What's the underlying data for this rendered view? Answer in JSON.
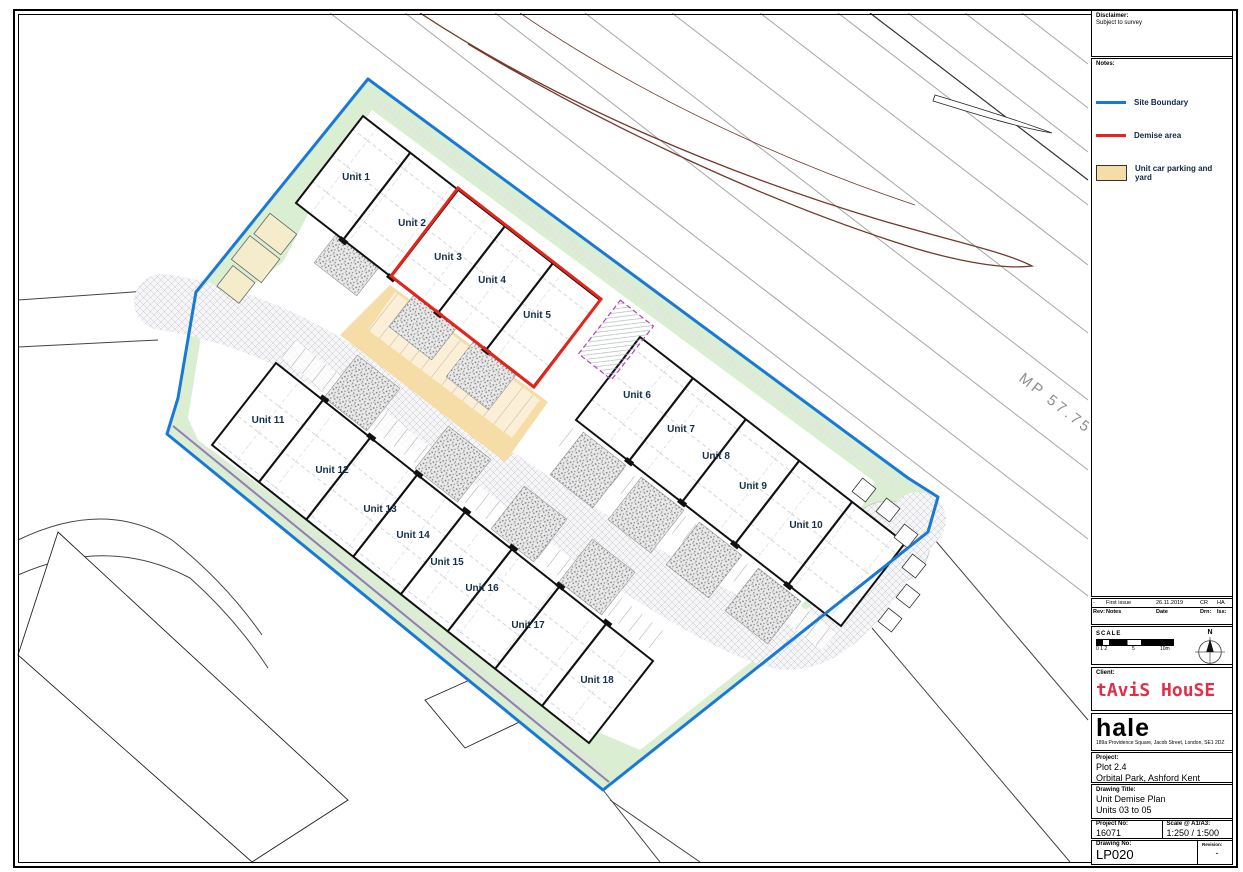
{
  "titleblock": {
    "disclaimer": {
      "label": "Disclaimer:",
      "body": "Subject to survey"
    },
    "notes_label": "Notes:",
    "legend": {
      "items": [
        {
          "swatch": "blue-line",
          "label": "Site Boundary"
        },
        {
          "swatch": "red-line",
          "label": "Demise area"
        },
        {
          "swatch": "tan-fill",
          "label": "Unit car parking and yard"
        }
      ]
    },
    "revisions": {
      "row": {
        "rev": "-",
        "notes": "First issue",
        "date": "26.11.2019",
        "drn": "CR",
        "iss": "HA"
      },
      "headers": {
        "rev": "Rev:",
        "notes": "Notes",
        "date": "Date",
        "drn": "Drn:",
        "iss": "Iss:"
      }
    },
    "scale_bar": {
      "label": "SCALE",
      "tick_left": "0 1 2",
      "tick_mid": "5",
      "tick_right": "10m"
    },
    "north": {
      "label": "N"
    },
    "client": {
      "label": "Client:",
      "name": "tAviS HouSE"
    },
    "firm": {
      "name": "hale",
      "address": "189a Providence Square, Jacob Street, London, SE1 2DZ"
    },
    "project": {
      "label": "Project:",
      "line1": "Plot 2.4",
      "line2": "Orbital Park, Ashford Kent"
    },
    "drawing_title": {
      "label": "Drawing Title:",
      "line1": "Unit Demise Plan",
      "line2": "Units 03 to 05"
    },
    "numbers": {
      "project_no_label": "Project No:",
      "project_no": "16071",
      "scale_label": "Scale @ A1/A3:",
      "scale": "1:250 / 1:500",
      "drawing_no_label": "Drawing No:",
      "drawing_no": "LP020",
      "revision_label": "Revision:",
      "revision": "-"
    }
  },
  "plan": {
    "milepost": "MP 57.75",
    "units": [
      {
        "label": "Unit 1",
        "x": 356,
        "y": 180
      },
      {
        "label": "Unit 2",
        "x": 412,
        "y": 226
      },
      {
        "label": "Unit 3",
        "x": 448,
        "y": 260
      },
      {
        "label": "Unit 4",
        "x": 492,
        "y": 283
      },
      {
        "label": "Unit 5",
        "x": 537,
        "y": 318
      },
      {
        "label": "Unit 6",
        "x": 637,
        "y": 398
      },
      {
        "label": "Unit 7",
        "x": 681,
        "y": 432
      },
      {
        "label": "Unit 8",
        "x": 716,
        "y": 459
      },
      {
        "label": "Unit 9",
        "x": 753,
        "y": 489
      },
      {
        "label": "Unit 10",
        "x": 806,
        "y": 528
      },
      {
        "label": "Unit 11",
        "x": 268,
        "y": 423
      },
      {
        "label": "Unit 12",
        "x": 332,
        "y": 473
      },
      {
        "label": "Unit 13",
        "x": 380,
        "y": 512
      },
      {
        "label": "Unit 14",
        "x": 413,
        "y": 538
      },
      {
        "label": "Unit 15",
        "x": 447,
        "y": 565
      },
      {
        "label": "Unit 16",
        "x": 482,
        "y": 591
      },
      {
        "label": "Unit 17",
        "x": 528,
        "y": 628
      },
      {
        "label": "Unit 18",
        "x": 597,
        "y": 683
      }
    ]
  },
  "colors": {
    "site_boundary": "#1a79d7",
    "demise_area": "#e8231a",
    "parking_yard": "#f6dca6",
    "landscape": "#daeed2",
    "logo_red": "#e03048"
  }
}
